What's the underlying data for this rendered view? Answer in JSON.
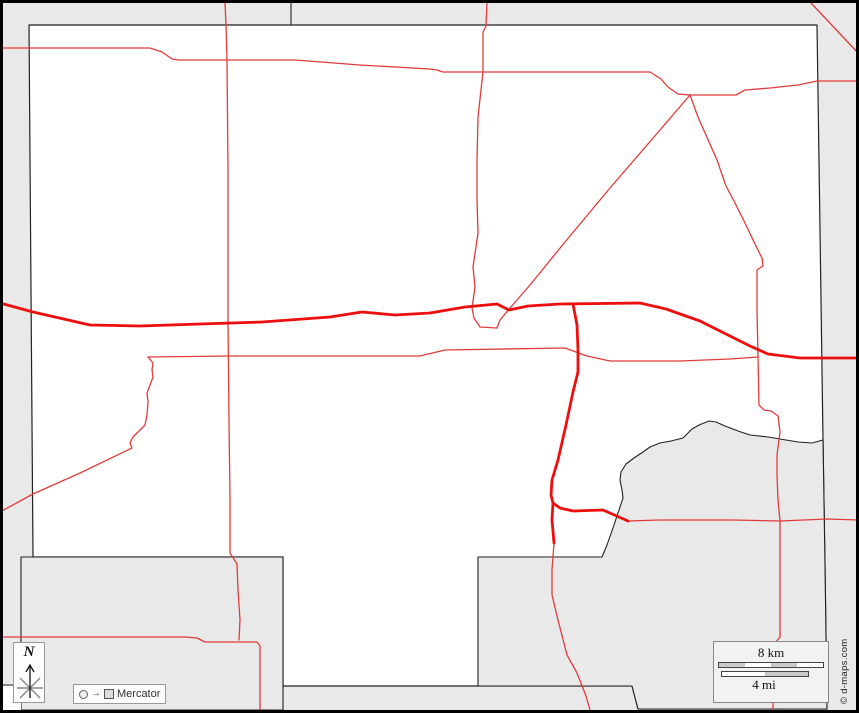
{
  "map": {
    "attribution": "© d-maps.com",
    "north_label": "N",
    "projection": {
      "label": "Mercator",
      "arrow_icon": "→"
    },
    "scale": {
      "km_label": "8 km",
      "mi_label": "4 mi",
      "km_segments": [
        "#c9c9c9",
        "#ffffff",
        "#c9c9c9",
        "#ffffff"
      ],
      "mi_segments": [
        "#ffffff",
        "#c9c9c9"
      ]
    },
    "colors": {
      "outside_area": "#e9e9e9",
      "land": "#ffffff",
      "boundary": "#222222",
      "road_minor": "#e23b3b",
      "road_major": "#ed0e0e",
      "frame": "#000000"
    },
    "layers": [
      {
        "name": "county-area",
        "cls": "land",
        "d": "M29,25 L817,25 L820,230 L823,440 L825,565 L827,709 L638,709 L632,686 L283,686 L283,557 L33,557 Z"
      },
      {
        "name": "se-region-area",
        "cls": "gray",
        "d": "M823,440 L812,443 L798,442 L786,440 L768,437 L750,435 L738,431 L725,426 L716,422 L709,421 L699,425 L692,429 L683,438 L671,441 L660,443 L650,447 L643,452 L634,458 L626,464 L621,472 L620,480 L622,490 L623,498 L618,513 L614,525 L607,545 L602,557 L478,557 L478,686 L632,686 L638,709 L827,709 L825,565 Z"
      },
      {
        "name": "sw-region-area",
        "cls": "gray",
        "d": "M21,557 L283,557 L283,710 L21,710 Z"
      },
      {
        "name": "sw-corner-white-patch",
        "cls": "white",
        "d": "M3,686 L21,686 L21,710 L3,710 Z"
      },
      {
        "name": "sw-corner-boundary-line",
        "cls": "b",
        "d": "M0,685 L21,685"
      },
      {
        "name": "top-boundary-segment",
        "cls": "b",
        "d": "M291,3 L291,25"
      },
      {
        "name": "road-north-horizontal",
        "cls": "rt",
        "d": "M0,48 L150,48 L162,52 L172,59 L178,60 L295,60 L360,65 L430,69 L437,70 L443,72 L650,72 L661,79 L668,87 L678,94 L690,95 L736,95 L745,90 L770,88 L798,85 L817,81 L859,81"
      },
      {
        "name": "road-west-vertical",
        "cls": "rt",
        "d": "M225,3 L226,25 L227,60 L228,170 L228,250 L228,322 L229,420 L230,500 L230,553 L237,564 L238,590 L240,620 L239,640"
      },
      {
        "name": "road-center-vertical",
        "cls": "rt",
        "d": "M487,3 L486,26 L483,32 L483,72 L478,117 L477,160 L477,200 L478,233 L473,267 L475,287 L472,308 L474,318 L480,327 L497,328"
      },
      {
        "name": "road-northeast-branch",
        "cls": "rt",
        "d": "M690,95 L698,117 L717,160 L726,186 L734,201 L744,221 L756,246 L762,258 L763,266 L757,270 L757,310 L758,357 L759,405 L764,410 L771,411 L778,416 L780,432 L777,455 L777,475 L778,500 L780,521 L780,560 L780,600 L780,637 L775,643 L773,680 L773,710"
      },
      {
        "name": "road-diagonal",
        "cls": "rt",
        "d": "M690,95 L660,130 L610,188 L565,242 L530,285 L510,308 L500,320 L497,328"
      },
      {
        "name": "road-mid-horizontal",
        "cls": "rt",
        "d": "M148,357 L230,356 L350,356 L420,356 L445,350 L565,348 L587,356 L610,361 L680,361 L730,359 L758,357"
      },
      {
        "name": "road-southwest-diagonal",
        "cls": "rt",
        "d": "M148,357 L153,363 L152,370 L153,377 L147,393 L148,402 L147,415 L145,425 L133,437 L130,443 L132,448 L80,473 L33,494 L0,512"
      },
      {
        "name": "road-south-horizontal",
        "cls": "rt",
        "d": "M0,637 L60,637 L185,637 L197,638 L205,642 L257,642 L260,646 L260,710"
      },
      {
        "name": "road-northeast-corner-diagonal",
        "cls": "rt",
        "d": "M811,3 L859,54"
      },
      {
        "name": "road-south-vertical-thin",
        "cls": "rt",
        "d": "M554,543 L552,570 L552,595 L558,620 L567,655 L577,673 L586,696 L590,710"
      },
      {
        "name": "road-southeast-horizontal-thin",
        "cls": "rt",
        "d": "M628,521 L660,520 L700,520 L733,520 L780,521 L827,519 L859,520"
      },
      {
        "name": "highway-main-east-west",
        "cls": "rk",
        "d": "M0,303 L33,312 L90,325 L140,326 L200,324 L262,322 L330,317 L362,312 L395,315 L430,313 L465,307 L497,304 L509,310 L528,306 L560,304 L640,303 L666,309 L700,321 L726,334 L750,346 L768,354 L800,358 L830,358 L859,358"
      },
      {
        "name": "highway-south-branch",
        "cls": "rk",
        "d": "M573,304 L577,325 L578,350 L578,372 L573,392 L566,425 L558,460 L552,480 L551,495 L553,503 L560,508 L573,511 L603,510 L628,521"
      },
      {
        "name": "highway-south-stub",
        "cls": "rk",
        "d": "M553,503 L552,520 L554,543"
      }
    ]
  }
}
